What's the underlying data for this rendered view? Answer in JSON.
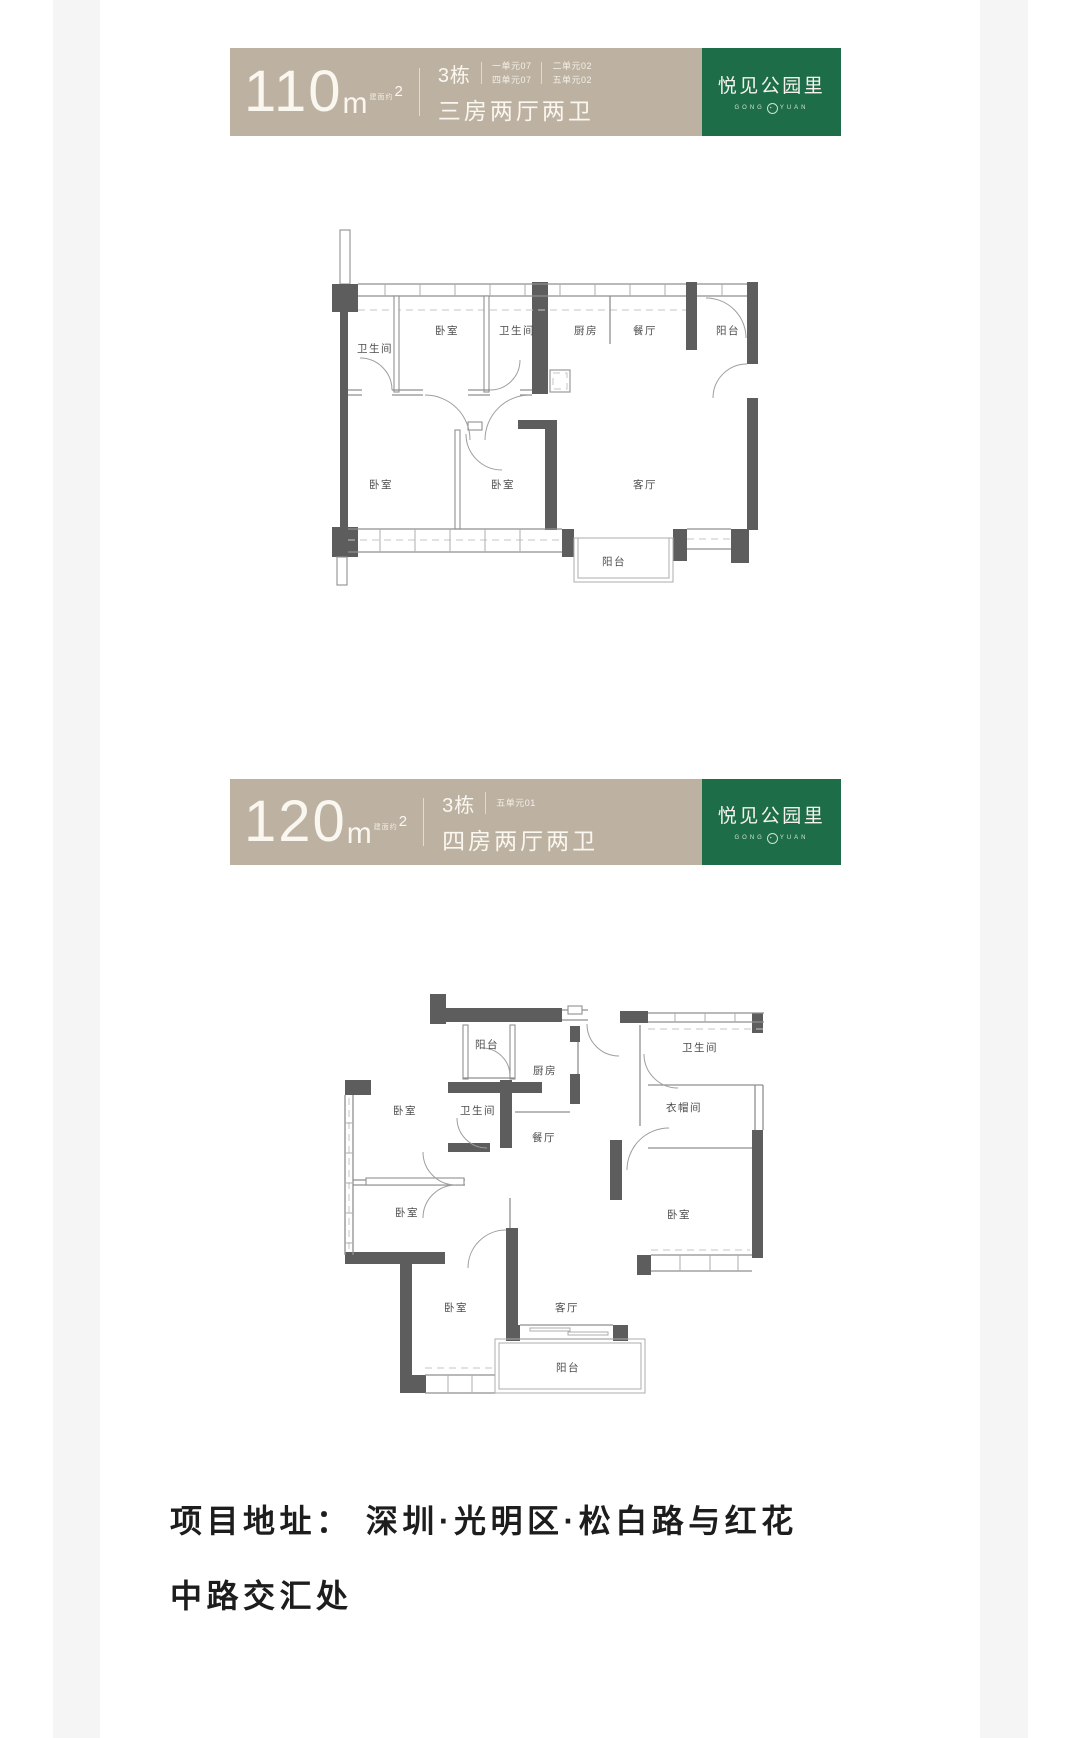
{
  "page": {
    "bg": "#ffffff",
    "side_strip_color": "#f5f5f5"
  },
  "banners": [
    {
      "area": "110",
      "area_unit": "m",
      "area_note": "建面约",
      "area_sup": "2",
      "building": "3栋",
      "units_col1": [
        "一单元07",
        "四单元07"
      ],
      "units_col2": [
        "二单元02",
        "五单元02"
      ],
      "layout": "三房两厅两卫",
      "bg": "#bdb2a2"
    },
    {
      "area": "120",
      "area_unit": "m",
      "area_note": "建面约",
      "area_sup": "2",
      "building": "3栋",
      "units_col1": [
        "五单元01"
      ],
      "units_col2": [],
      "layout": "四房两厅两卫",
      "bg": "#bdb2a2"
    }
  ],
  "logo": {
    "name": "悦见公园里",
    "sub_left": "GONG",
    "sub_right": "YUAN",
    "sub_mark": "①",
    "bg": "#1e6d49"
  },
  "plans": [
    {
      "rooms": [
        "卫生间",
        "卧室",
        "卫生间",
        "厨房",
        "餐厅",
        "阳台",
        "卧室",
        "卧室",
        "客厅",
        "阳台"
      ]
    },
    {
      "rooms": [
        "阳台",
        "厨房",
        "卫生间",
        "卧室",
        "卫生间",
        "餐厅",
        "衣帽间",
        "卧室",
        "卧室",
        "卧室",
        "客厅",
        "阳台"
      ]
    }
  ],
  "address": {
    "line1": "项目地址： 深圳·光明区·松白路与红花",
    "line2": "中路交汇处"
  }
}
